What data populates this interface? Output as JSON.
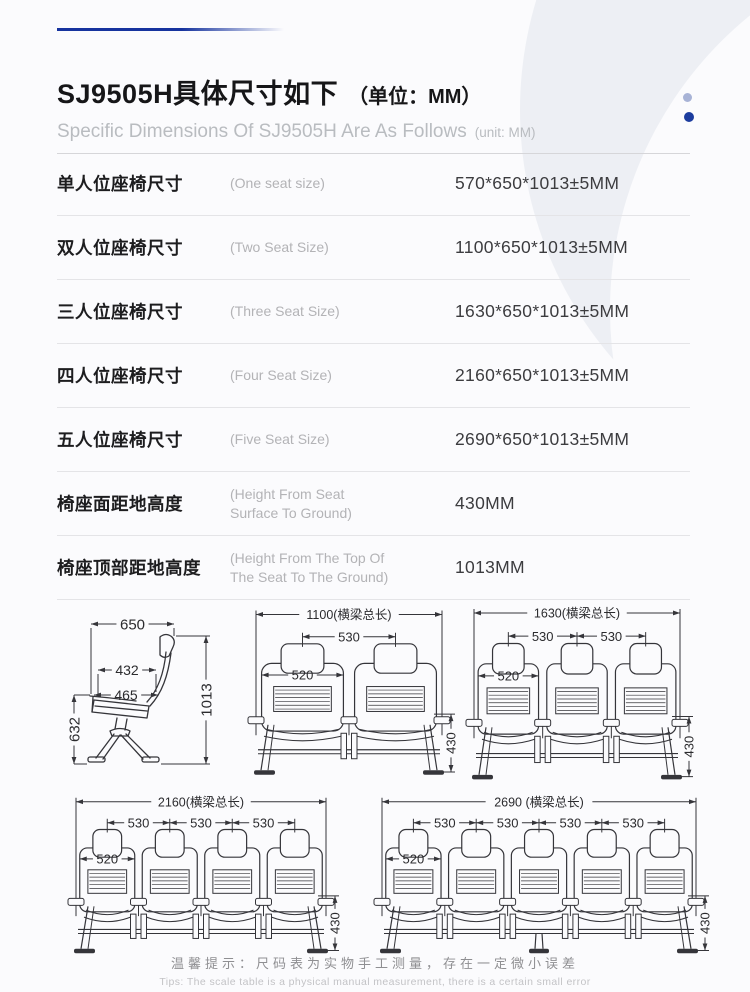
{
  "page": {
    "colors": {
      "top_line": "#16339e",
      "dot_dark": "#1c3c9e",
      "dot_light": "#a8b3d6",
      "line": "#35353a",
      "dim_text": "#2b2b2e"
    }
  },
  "header": {
    "title_cn": "SJ9505H具体尺寸如下",
    "title_unit": "（单位：MM）",
    "subtitle_en": "Specific Dimensions Of SJ9505H Are As Follows",
    "subtitle_unit": "(unit: MM)"
  },
  "spec_table": {
    "rows": [
      {
        "label_cn": "单人位座椅尺寸",
        "label_en": "(One seat size)",
        "value": "570*650*1013±5MM"
      },
      {
        "label_cn": "双人位座椅尺寸",
        "label_en": "(Two Seat Size)",
        "value": "1100*650*1013±5MM"
      },
      {
        "label_cn": "三人位座椅尺寸",
        "label_en": "(Three Seat Size)",
        "value": "1630*650*1013±5MM"
      },
      {
        "label_cn": "四人位座椅尺寸",
        "label_en": "(Four Seat Size)",
        "value": "2160*650*1013±5MM"
      },
      {
        "label_cn": "五人位座椅尺寸",
        "label_en": "(Five Seat Size)",
        "value": "2690*650*1013±5MM"
      },
      {
        "label_cn": "椅座面距地高度",
        "label_en": "(Height From Seat Surface To Ground)",
        "value": "430MM"
      },
      {
        "label_cn": "椅座顶部距地高度",
        "label_en": "(Height From The Top Of The Seat To The Ground)",
        "value": "1013MM"
      }
    ]
  },
  "diagrams": {
    "single": {
      "top_width": "650",
      "seat_depth": "432",
      "seat_width": "465",
      "total_height": "1013",
      "arm_height": "632"
    },
    "benches": [
      {
        "seats": 2,
        "beam_label": "1100(横梁总长)",
        "pitch_label": "530",
        "seat_label": "520",
        "height_label": "430",
        "center_leg": false
      },
      {
        "seats": 3,
        "beam_label": "1630(横梁总长)",
        "pitch_label": "530",
        "seat_label": "520",
        "height_label": "430",
        "center_leg": false
      },
      {
        "seats": 4,
        "beam_label": "2160(横梁总长)",
        "pitch_label": "530",
        "seat_label": "520",
        "height_label": "430",
        "center_leg": false
      },
      {
        "seats": 5,
        "beam_label": "2690 (横梁总长)",
        "pitch_label": "530",
        "seat_label": "520",
        "height_label": "430",
        "center_leg": true
      }
    ]
  },
  "footer": {
    "note_cn": "温馨提示：尺码表为实物手工测量，存在一定微小误差",
    "note_en": "Tips: The scale table is a physical manual measurement, there is a certain small error"
  }
}
